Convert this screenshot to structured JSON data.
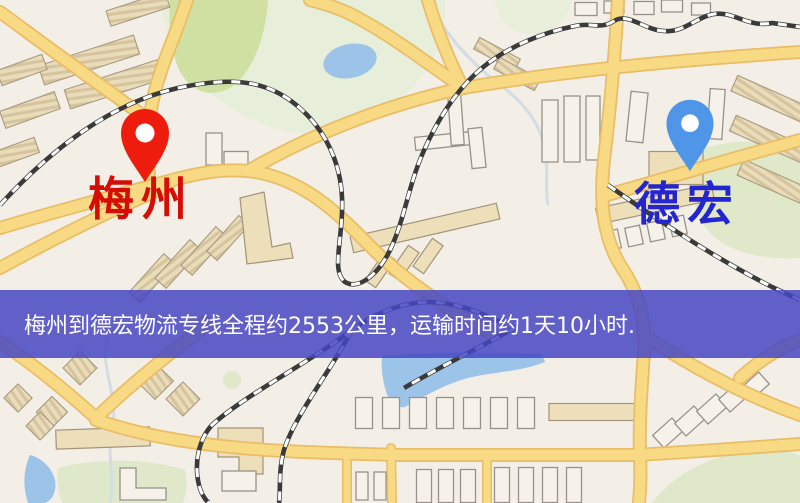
{
  "banner": {
    "text": "梅州到德宏物流专线全程约2553公里，运输时间约1天10小时."
  },
  "markers": {
    "origin": {
      "label": "梅州",
      "pin_icon": "red-map-pin"
    },
    "destination": {
      "label": "德宏",
      "pin_icon": "blue-map-pin"
    }
  },
  "colors": {
    "map_bg": "#f3efe7",
    "pin_red": "#ed1c0d",
    "label_red": "#d60d04",
    "pin_blue": "#4f96e8",
    "label_blue": "#2326cf",
    "banner_bg": "#4747c3",
    "banner_text": "#ffffff",
    "road_yellow": "#f8da84",
    "road_casing": "#e9bd66",
    "water_blue": "#9cc3e8",
    "park_green": "#dfe9c9",
    "rail_dark": "#3a3a3a"
  }
}
